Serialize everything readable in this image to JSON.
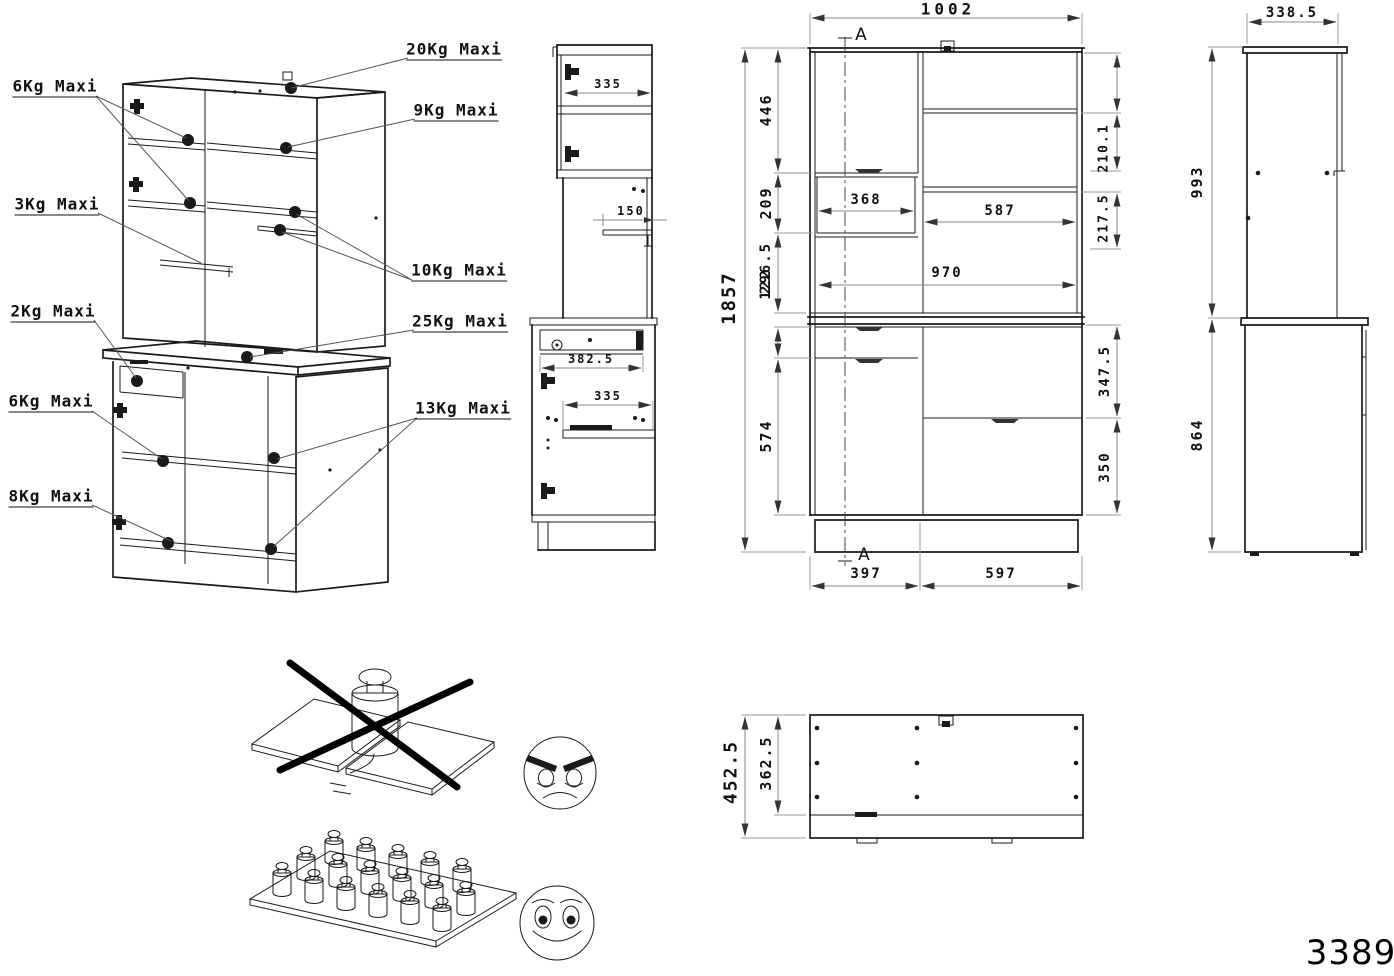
{
  "page": {
    "drawing_number": "3389"
  },
  "perspective_view": {
    "labels": {
      "top_panel": "20Kg Maxi",
      "upper_left_shelves": "6Kg Maxi",
      "upper_right_shelf": "9Kg Maxi",
      "small_mid_shelf": "3Kg Maxi",
      "rail_shelf": "10Kg Maxi",
      "drawer": "2Kg Maxi",
      "counter_top": "25Kg Maxi",
      "base_left_shelf": "6Kg Maxi",
      "base_right_shelves": "13Kg Maxi",
      "base_bottom": "8Kg Maxi"
    }
  },
  "side_section_view": {
    "dims": {
      "upper_depth": "335",
      "shelf_setback": "150",
      "drawer_depth": "382.5",
      "lower_shelf_depth": "335"
    }
  },
  "front_view": {
    "overall_width": "1002",
    "overall_height": "1857",
    "section_marker_top": "A",
    "section_marker_bottom": "A",
    "upper_door_height": "446",
    "niche_height": "209",
    "open_height": "296.5",
    "drawer_height": "122",
    "lower_door_height": "574",
    "niche_width": "368",
    "right_shelf_width": "587",
    "interior_width": "970",
    "right_upper_gap": "210.1",
    "right_lower_gap": "217.5",
    "right_open_height": "347.5",
    "right_drawer_height": "350",
    "left_bay_width": "397",
    "right_bay_width": "597"
  },
  "right_side_view": {
    "dims": {
      "upper_depth": "338.5",
      "upper_height": "993",
      "lower_height": "864"
    }
  },
  "base_panel_view": {
    "dims": {
      "overall_height": "452.5",
      "panel_height": "362.5"
    }
  },
  "pictograms": {
    "forbidden_icon": "no-concentrated-load",
    "forbidden_face": "angry-face",
    "allowed_icon": "distributed-load",
    "allowed_face": "happy-face"
  }
}
